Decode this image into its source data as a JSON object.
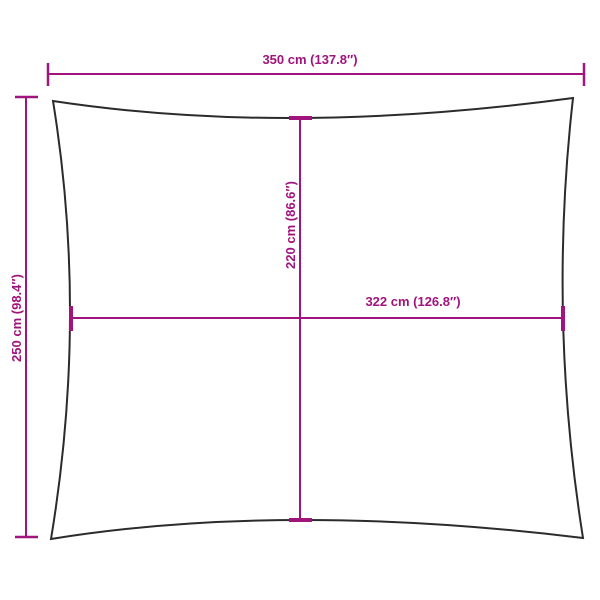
{
  "dimension_labels": {
    "width": "350 cm (137.8″)",
    "height": "250 cm (98.4″)",
    "inner_height": "220 cm (86.6″)",
    "inner_width": "322 cm (126.8″)"
  },
  "colors": {
    "dimension_accent": "#A0147E",
    "sail_outline": "#2b2b2b",
    "background": "#ffffff"
  }
}
